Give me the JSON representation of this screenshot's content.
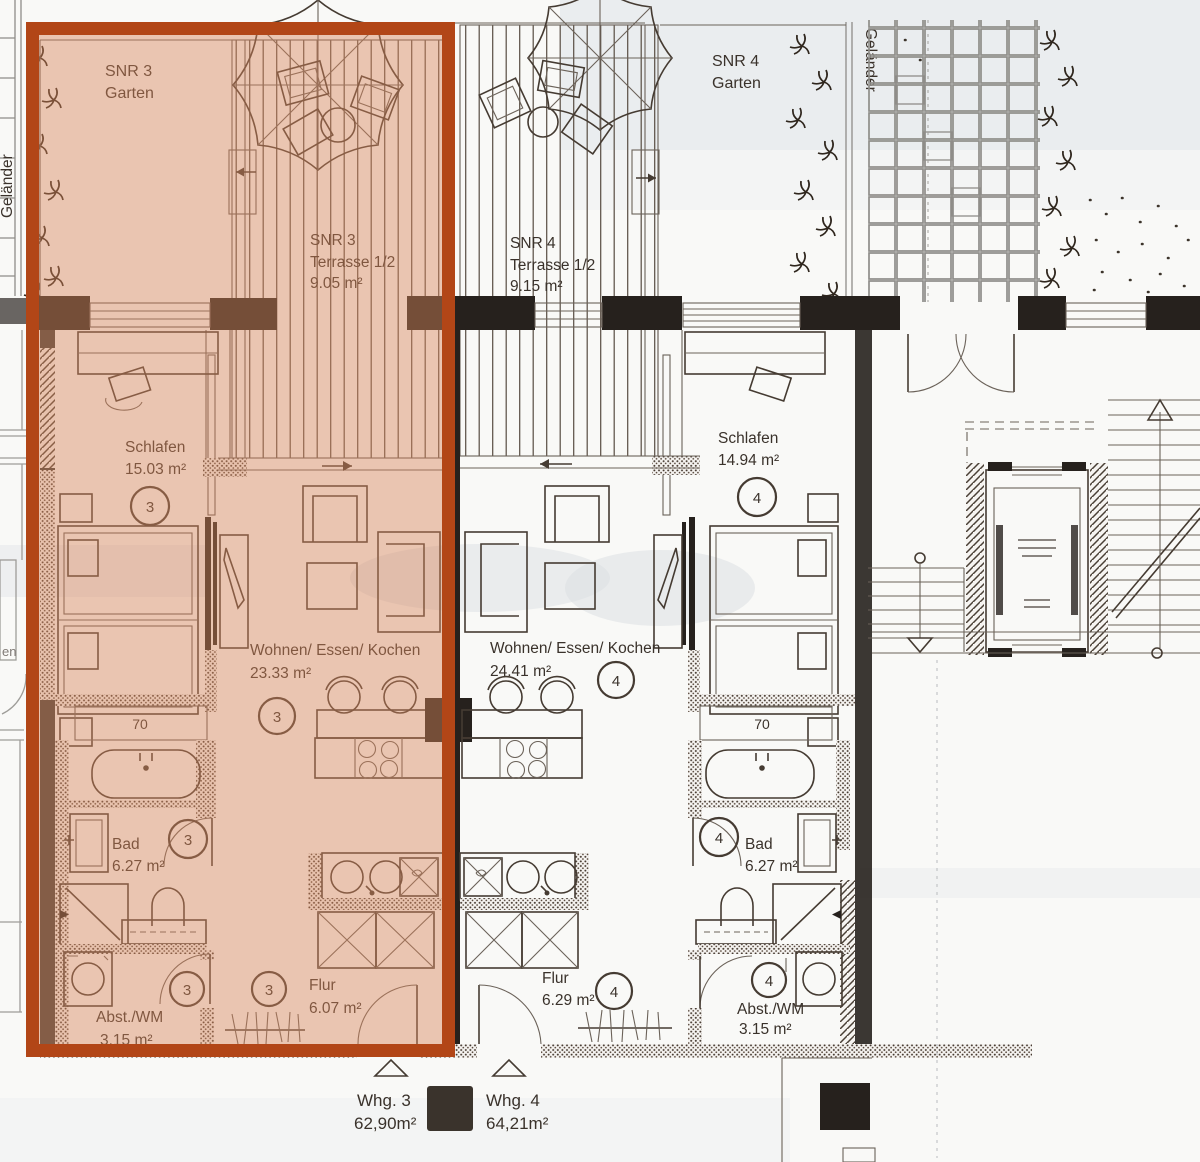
{
  "plan": {
    "garden3": {
      "title": "SNR 3",
      "subtitle": "Garten"
    },
    "terrace3": {
      "title": "SNR 3",
      "subtitle": "Terrasse 1/2",
      "area": "9.05 m²"
    },
    "terrace4": {
      "title": "SNR 4",
      "subtitle": "Terrasse 1/2",
      "area": "9.15 m²"
    },
    "garden4": {
      "title": "SNR 4",
      "subtitle": "Garten"
    },
    "railing_left": "Geländer",
    "railing_right": "Geländer",
    "neighbor_fragment": "en"
  },
  "apartment3": {
    "badge": "3",
    "closet_label": "70",
    "rooms": {
      "schlafen": {
        "name": "Schlafen",
        "area": "15.03 m²"
      },
      "wohnen": {
        "name": "Wohnen/ Essen/ Kochen",
        "area": "23.33 m²"
      },
      "bad": {
        "name": "Bad",
        "area": "6.27 m²"
      },
      "abst": {
        "name": "Abst./WM",
        "area": "3.15 m²"
      },
      "flur": {
        "name": "Flur",
        "area": "6.07 m²"
      }
    }
  },
  "apartment4": {
    "badge": "4",
    "closet_label": "70",
    "rooms": {
      "schlafen": {
        "name": "Schlafen",
        "area": "14.94 m²"
      },
      "wohnen": {
        "name": "Wohnen/ Essen/ Kochen",
        "area": "24.41 m²"
      },
      "bad": {
        "name": "Bad",
        "area": "6.27 m²"
      },
      "abst": {
        "name": "Abst./WM",
        "area": "3.15 m²"
      },
      "flur": {
        "name": "Flur",
        "area": "6.29 m²"
      }
    }
  },
  "legend": {
    "whg3": {
      "label": "Whg. 3",
      "area": "62,90m²"
    },
    "whg4": {
      "label": "Whg. 4",
      "area": "64,21m²"
    }
  },
  "colors": {
    "highlight_border": "#b24617",
    "highlight_fill": "rgba(214,134,92,0.45)",
    "ink": "#3a322b",
    "wall": "#26211d",
    "paper": "#f9f9f7"
  }
}
